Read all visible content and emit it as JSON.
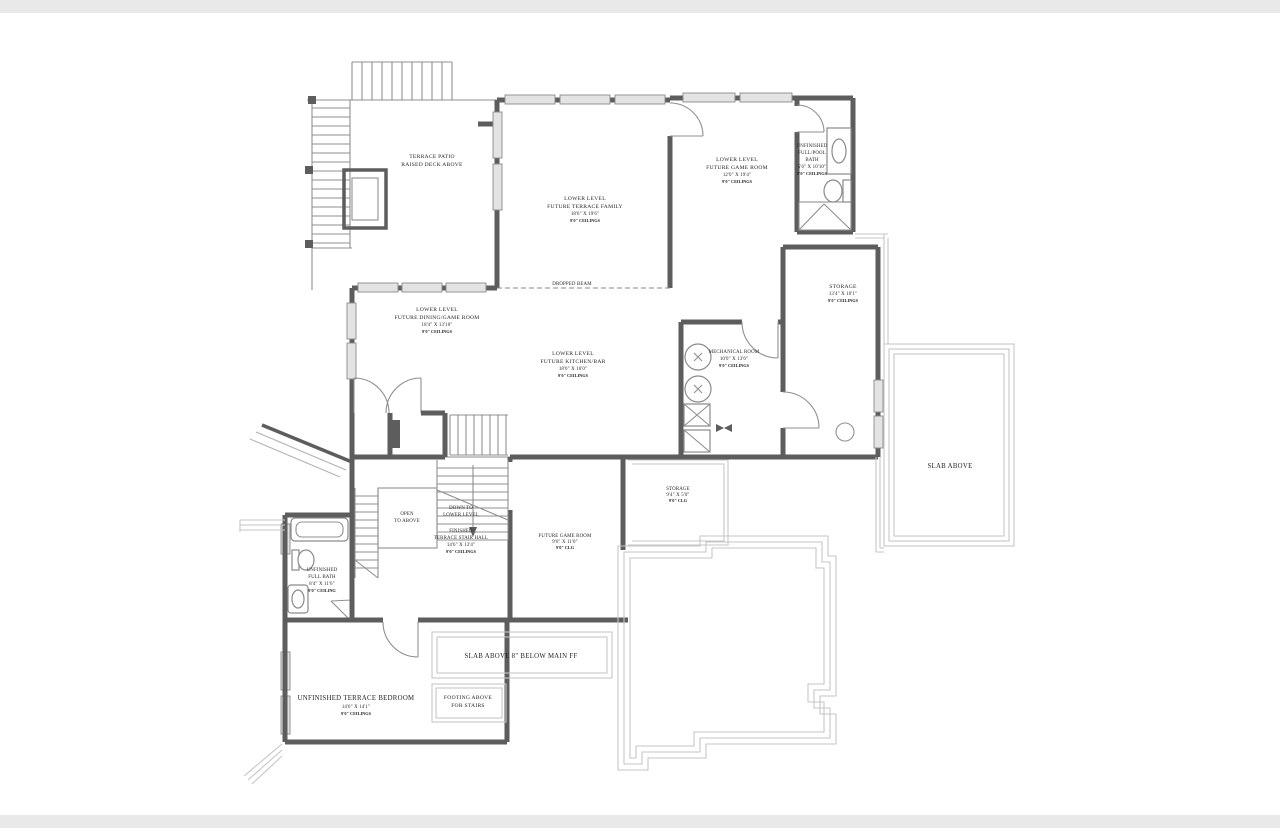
{
  "drawing": {
    "type": "architectural-floor-plan",
    "level": "lower-level-terrace",
    "wall_color": "#5d5d5d",
    "thin_line_color": "#8f8f8f",
    "footing_line_color": "#c6c6c6",
    "window_fill": "#e3e3e3",
    "text_color": "#1f1f1f",
    "background": "#ffffff",
    "band_color": "#e9e9e9"
  },
  "rooms": {
    "terrace_patio": {
      "name1": "TERRACE PATIO",
      "name2": "RAISED DECK ABOVE"
    },
    "terrace_family": {
      "level": "LOWER LEVEL",
      "name": "FUTURE TERRACE FAMILY",
      "dims": "18'6\" X 19'6\"",
      "ceiling": "9'0\" CEILINGS"
    },
    "game_room": {
      "level": "LOWER LEVEL",
      "name": "FUTURE GAME ROOM",
      "dims": "12'0\" X 19'4\"",
      "ceiling": "9'0\" CEILINGS"
    },
    "pool_bath": {
      "l1": "UNFINISHED",
      "l2": "FULL/POOL",
      "l3": "BATH",
      "dims": "5'6\" X 10'10\"",
      "ceiling": "9'0\" CEILINGS"
    },
    "storage": {
      "name": "STORAGE",
      "dims": "13'4\" X 10'1\"",
      "ceiling": "9'0\" CEILINGS"
    },
    "dining_game": {
      "level": "LOWER LEVEL",
      "name": "FUTURE DINING/GAME ROOM",
      "dims": "18'4\" X 13'10\"",
      "ceiling": "9'0\" CEILINGS"
    },
    "kitchen_bar": {
      "level": "LOWER LEVEL",
      "name": "FUTURE KITCHEN/BAR",
      "dims": "18'0\" X 16'0\"",
      "ceiling": "9'0\" CEILINGS"
    },
    "mechanical": {
      "name": "MECHANICAL ROOM",
      "dims": "10'0\" X 13'6\"",
      "ceiling": "9'0\" CEILINGS"
    },
    "slab_above": {
      "name": "SLAB ABOVE"
    },
    "storage_small": {
      "name": "STORAGE",
      "dims": "9'4\" X 5'0\"",
      "ceiling": "9'0\" CLG"
    },
    "open_to_above": {
      "l1": "OPEN",
      "l2": "TO ABOVE"
    },
    "stair_direction": {
      "l1": "DOWN TO",
      "l2": "LOWER LEVEL"
    },
    "stair_hall": {
      "l1": "FINISHED",
      "l2": "TERRACE STAIR HALL",
      "dims": "14'6\" X 13'4\"",
      "ceiling": "9'0\" CEILINGS"
    },
    "game_room_small": {
      "name": "FUTURE GAME ROOM",
      "dims": "9'6\" X 11'0\"",
      "ceiling": "9'0\" CLG"
    },
    "full_bath": {
      "l1": "UNFINISHED",
      "l2": "FULL BATH",
      "dims": "8'4\" X 11'6\"",
      "ceiling": "9'0\" CEILING"
    },
    "slab_note": {
      "name": "SLAB ABOVE 8\" BELOW MAIN FF"
    },
    "footing_note": {
      "l1": "FOOTING ABOVE",
      "l2": "FOR STAIRS"
    },
    "terrace_bedroom": {
      "name": "UNFINISHED TERRACE BEDROOM",
      "dims": "14'6\" X 14'1\"",
      "ceiling": "9'0\" CEILINGS"
    },
    "beam_note": {
      "name": "DROPPED BEAM"
    }
  }
}
